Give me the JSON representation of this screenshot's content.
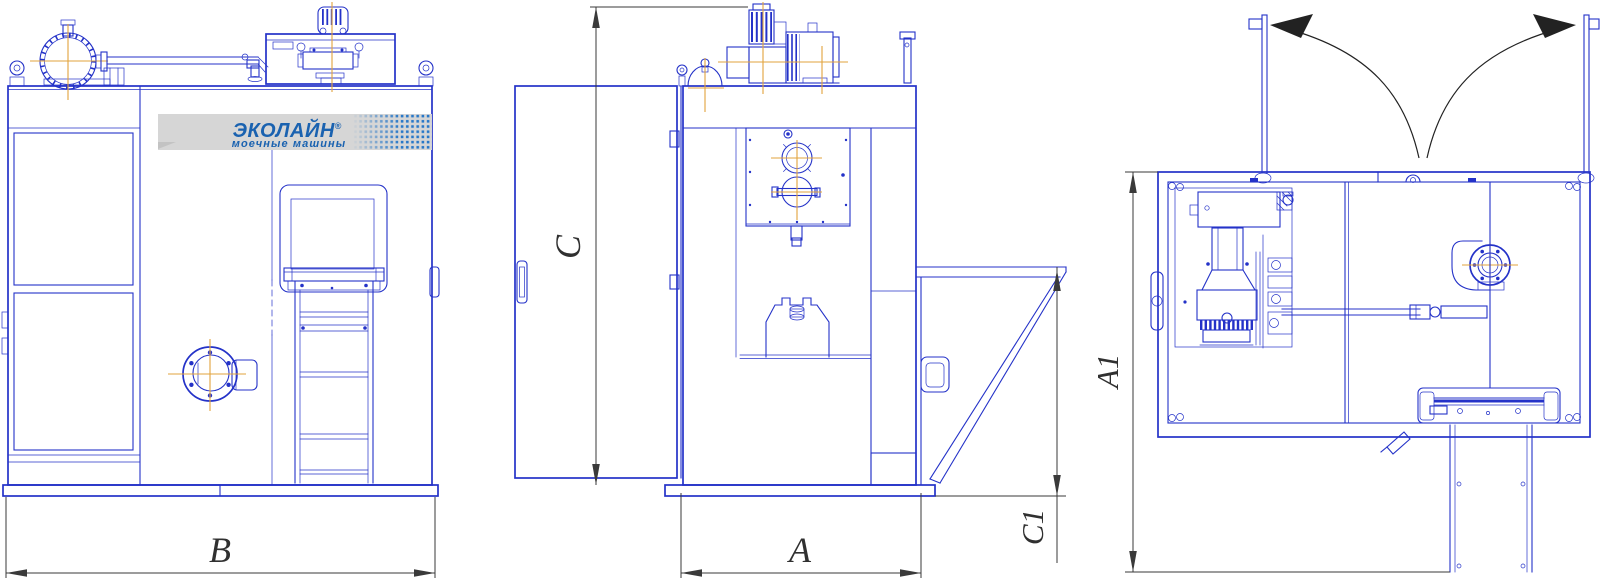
{
  "drawing": {
    "title": "industrial washing machine dimensional drawing",
    "views": [
      {
        "id": "front",
        "name": "front view"
      },
      {
        "id": "side",
        "name": "side view"
      },
      {
        "id": "top",
        "name": "top view with doors open"
      }
    ],
    "dims": {
      "b": "B",
      "c": "C",
      "a": "A",
      "c1": "C1",
      "a1": "A1"
    },
    "logo": {
      "brand": "ЭКОЛАЙН",
      "reg": "®",
      "tagline": "моечные машины"
    },
    "colors": {
      "line": "#2432c8",
      "centerline": "#e2a33c",
      "dimension": "#3a3a3a",
      "logo_blue": "#1a62b0",
      "band_gray": "#d6d6d6",
      "dot_blue": "#2878c8",
      "arrow_black": "#222222",
      "background": "#ffffff"
    }
  }
}
